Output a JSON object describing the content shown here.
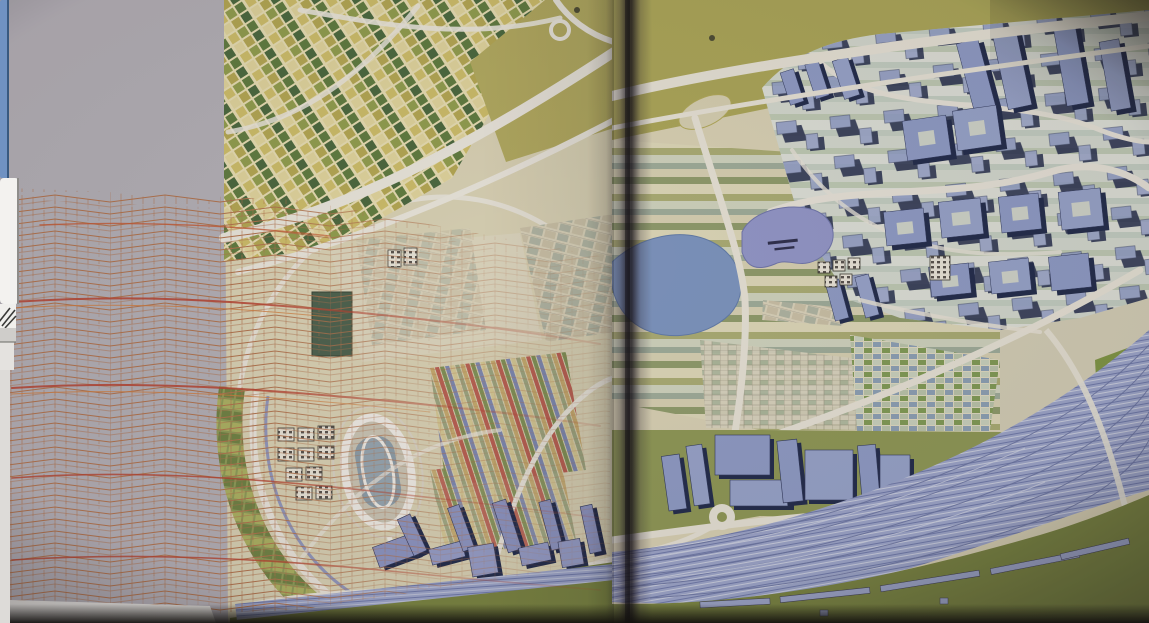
{
  "desktop": {
    "scrollbar_blue": "#7092c2",
    "scrollbar_border": "#39597f",
    "panel_white": "#f3f2ef",
    "panel_border": "#8e8d8a",
    "grip_line": "#3a3a38",
    "strip_grey": "#cfcdca",
    "strip_pale": "#e4e2df",
    "edge_column": "#dddbd8"
  },
  "photo": {
    "colors": {
      "page_margin": "#b2aeb4",
      "map_ground": "#d8d1b2",
      "field_olive": "#aaa554",
      "mosaic_bg": "#e6ddb0",
      "road_white": "#e9e5da",
      "lake_blue": "#7a93bd",
      "lake_purple": "#9095c6",
      "building_face": "#8d9ac4",
      "building_shadow": "#1f2847",
      "grass_olive": "#8d9752",
      "grass_dark": "#77823d",
      "tracks_band": "#9ba4c8",
      "mesh_orange": "#c06a38",
      "mesh_red": "#b5402b",
      "dark_block": "#4a5f4a",
      "stadium_infield": "#8b9ca6",
      "page_edge_white": "#e9e7e2",
      "spine_dark": "#1c161f"
    }
  }
}
